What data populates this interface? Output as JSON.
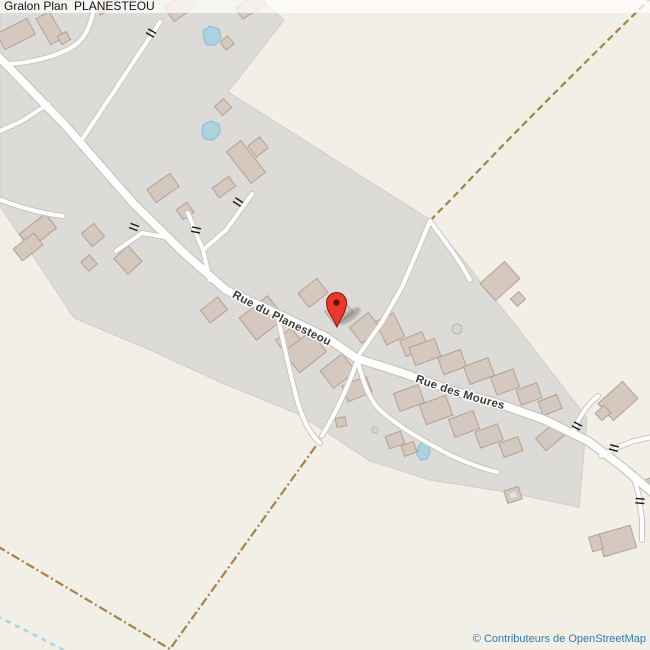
{
  "header": {
    "title": "Gralon Plan  PLANESTEOU"
  },
  "map": {
    "street_labels": [
      {
        "name": "Rue du Planesteou"
      },
      {
        "name": "Rue des Moures"
      }
    ],
    "marker": {
      "color": "#e8392b"
    },
    "colors": {
      "background": "#f2efe7",
      "residential_area": "#dcdbd8",
      "building_fill": "#d5c8be",
      "building_stroke": "#b3a191",
      "road_fill": "#ffffff",
      "road_casing": "#c9c6c1",
      "track": "#a5824a",
      "water_fill": "#abd4e0",
      "water_stroke": "#8cc0d2",
      "stream": "#a5d8e1"
    }
  },
  "footer": {
    "attribution": "© Contributeurs de OpenStreetMap"
  }
}
